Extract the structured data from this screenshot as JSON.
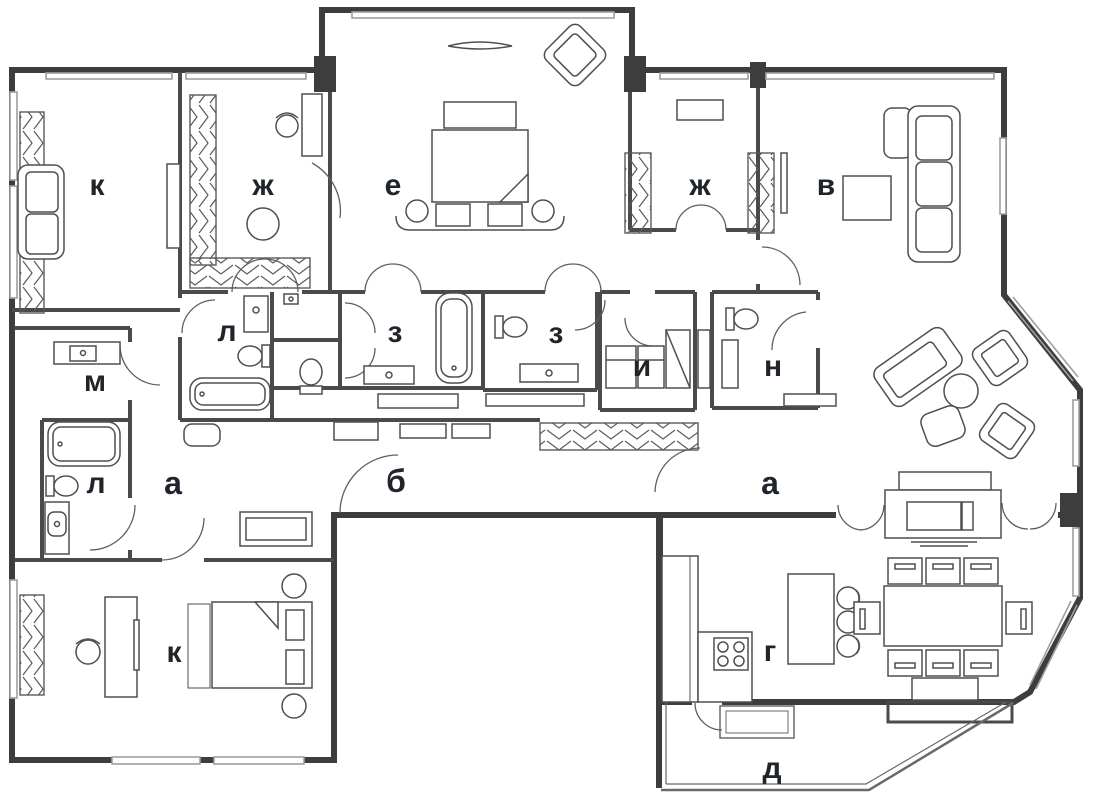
{
  "plan": {
    "kind": "apartment-floor-plan",
    "colors": {
      "wall": "#3d3d3d",
      "interior_wall": "#4a4a4a",
      "window": "#9f9f9f",
      "furniture": "#4f4f4f",
      "hatch": "#5a5a5a",
      "label": "#20242b",
      "background": "#ffffff"
    },
    "rooms": [
      {
        "label": "к",
        "name": "study-top-left"
      },
      {
        "label": "ж",
        "name": "dressing-left"
      },
      {
        "label": "е",
        "name": "master-bedroom"
      },
      {
        "label": "ж",
        "name": "dressing-right"
      },
      {
        "label": "в",
        "name": "living-room"
      },
      {
        "label": "л",
        "name": "bathroom-upper"
      },
      {
        "label": "м",
        "name": "laundry"
      },
      {
        "label": "з",
        "name": "bathroom-center-left"
      },
      {
        "label": "з",
        "name": "bathroom-center-right"
      },
      {
        "label": "и",
        "name": "utility-room"
      },
      {
        "label": "н",
        "name": "wc"
      },
      {
        "label": "л",
        "name": "bathroom-lower"
      },
      {
        "label": "а",
        "name": "hall-left"
      },
      {
        "label": "б",
        "name": "corridor"
      },
      {
        "label": "а",
        "name": "hall-right"
      },
      {
        "label": "г",
        "name": "kitchen"
      },
      {
        "label": "д",
        "name": "balcony"
      },
      {
        "label": "к",
        "name": "bedroom-bottom-left"
      }
    ]
  }
}
